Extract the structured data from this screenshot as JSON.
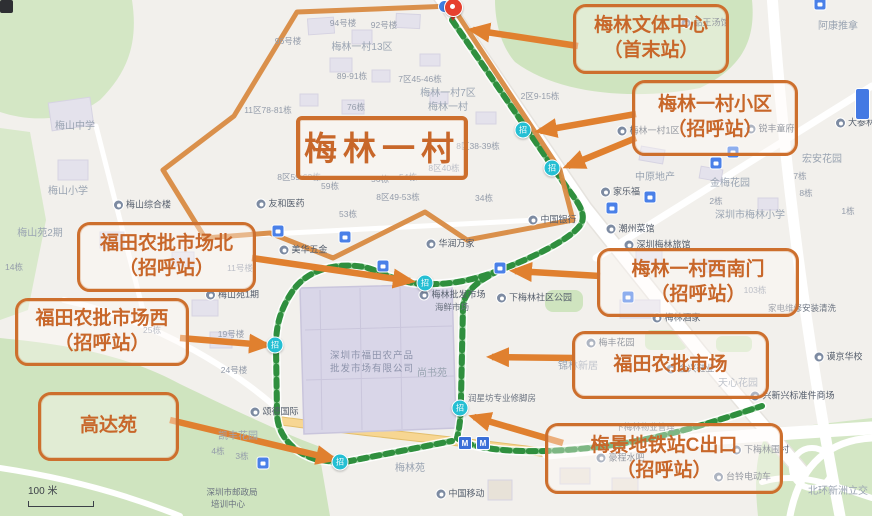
{
  "colors": {
    "accent": "#cd6f2d",
    "arrow": "#e0802f",
    "route_green": "#2f8f3e",
    "route_light": "#9fd3a4",
    "station_cyan": "#25bfd3",
    "park": "#d4e7c5",
    "road_yellow": "#f7d692",
    "pin_red": "#e6402e"
  },
  "map": {
    "scale_text": "100 米",
    "station_glyph": "招",
    "metro_glyph": "M",
    "terminal_pin": [
      452,
      22
    ],
    "stations": [
      [
        523,
        130
      ],
      [
        552,
        168
      ],
      [
        425,
        283
      ],
      [
        275,
        345
      ],
      [
        340,
        462
      ],
      [
        460,
        408
      ]
    ],
    "bus_icons": [
      [
        820,
        4
      ],
      [
        733,
        152
      ],
      [
        716,
        163
      ],
      [
        650,
        197
      ],
      [
        612,
        208
      ],
      [
        278,
        231
      ],
      [
        345,
        237
      ],
      [
        383,
        266
      ],
      [
        500,
        268
      ],
      [
        628,
        297
      ],
      [
        263,
        463
      ]
    ],
    "metro_icons": [
      [
        465,
        443
      ],
      [
        483,
        443
      ]
    ],
    "labels": [
      {
        "text": "梅山中学",
        "x": 75,
        "y": 127,
        "type": "ghost"
      },
      {
        "text": "梅山小学",
        "x": 68,
        "y": 192,
        "type": "ghost"
      },
      {
        "text": "梅山综合楼",
        "x": 142,
        "y": 205,
        "type": "poi"
      },
      {
        "text": "友和医药",
        "x": 280,
        "y": 204,
        "type": "poi"
      },
      {
        "text": "梅山苑2期",
        "x": 40,
        "y": 234,
        "type": "ghost"
      },
      {
        "text": "梅山苑1期",
        "x": 232,
        "y": 295,
        "type": "poi"
      },
      {
        "text": "14栋",
        "x": 14,
        "y": 267,
        "type": "num"
      },
      {
        "text": "11号楼",
        "x": 240,
        "y": 268,
        "type": "num"
      },
      {
        "text": "19号楼",
        "x": 231,
        "y": 334,
        "type": "num"
      },
      {
        "text": "24号楼",
        "x": 234,
        "y": 370,
        "type": "num"
      },
      {
        "text": "25栋",
        "x": 152,
        "y": 330,
        "type": "num"
      },
      {
        "text": "96号楼",
        "x": 288,
        "y": 41,
        "type": "num"
      },
      {
        "text": "94号楼",
        "x": 343,
        "y": 23,
        "type": "num"
      },
      {
        "text": "92号楼",
        "x": 384,
        "y": 25,
        "type": "num"
      },
      {
        "text": "梅林一村13区",
        "x": 362,
        "y": 48,
        "type": "ghost"
      },
      {
        "text": "89-91栋",
        "x": 352,
        "y": 76,
        "type": "num"
      },
      {
        "text": "7区45-46栋",
        "x": 420,
        "y": 79,
        "type": "num"
      },
      {
        "text": "76栋",
        "x": 356,
        "y": 107,
        "type": "num"
      },
      {
        "text": "11区78-81栋",
        "x": 268,
        "y": 110,
        "type": "num"
      },
      {
        "text": "梅林一村7区",
        "x": 448,
        "y": 94,
        "type": "ghost"
      },
      {
        "text": "2区9-15栋",
        "x": 540,
        "y": 96,
        "type": "num"
      },
      {
        "text": "梅林一村",
        "x": 448,
        "y": 108,
        "type": "ghost"
      },
      {
        "text": "梅林一村1区",
        "x": 648,
        "y": 131,
        "type": "poi"
      },
      {
        "text": "锐丰童府",
        "x": 770,
        "y": 129,
        "type": "poi"
      },
      {
        "text": "品王汤馆",
        "x": 705,
        "y": 23,
        "type": "poi"
      },
      {
        "text": "阿康推拿",
        "x": 838,
        "y": 27,
        "type": "ghost"
      },
      {
        "text": "大参林",
        "x": 855,
        "y": 123,
        "type": "poi"
      },
      {
        "text": "8区38-39栋",
        "x": 478,
        "y": 146,
        "type": "num"
      },
      {
        "text": "8区40栋",
        "x": 444,
        "y": 168,
        "type": "num"
      },
      {
        "text": "8区59-62栋",
        "x": 299,
        "y": 177,
        "type": "num"
      },
      {
        "text": "59栋",
        "x": 330,
        "y": 186,
        "type": "num"
      },
      {
        "text": "56栋",
        "x": 380,
        "y": 179,
        "type": "num"
      },
      {
        "text": "54栋",
        "x": 408,
        "y": 177,
        "type": "num"
      },
      {
        "text": "8区49-53栋",
        "x": 398,
        "y": 197,
        "type": "num"
      },
      {
        "text": "53栋",
        "x": 348,
        "y": 214,
        "type": "num"
      },
      {
        "text": "34栋",
        "x": 484,
        "y": 198,
        "type": "num"
      },
      {
        "text": "中国银行",
        "x": 552,
        "y": 220,
        "type": "poi"
      },
      {
        "text": "美华五金",
        "x": 303,
        "y": 250,
        "type": "poi"
      },
      {
        "text": "华润万家",
        "x": 450,
        "y": 244,
        "type": "poi"
      },
      {
        "text": "梅林批发市场",
        "x": 452,
        "y": 295,
        "type": "poi"
      },
      {
        "text": "海鲜市场",
        "x": 452,
        "y": 307,
        "type": "plain"
      },
      {
        "text": "下梅林社区公园",
        "x": 534,
        "y": 298,
        "type": "poi"
      },
      {
        "text": "家乐福",
        "x": 620,
        "y": 192,
        "type": "poi"
      },
      {
        "text": "中原地产",
        "x": 655,
        "y": 178,
        "type": "ghost"
      },
      {
        "text": "金梅花园",
        "x": 730,
        "y": 184,
        "type": "ghost"
      },
      {
        "text": "宏安花园",
        "x": 822,
        "y": 160,
        "type": "ghost"
      },
      {
        "text": "7栋",
        "x": 800,
        "y": 176,
        "type": "num"
      },
      {
        "text": "8栋",
        "x": 806,
        "y": 193,
        "type": "num"
      },
      {
        "text": "2栋",
        "x": 716,
        "y": 201,
        "type": "num"
      },
      {
        "text": "1栋",
        "x": 848,
        "y": 211,
        "type": "num"
      },
      {
        "text": "深圳市梅林小学",
        "x": 750,
        "y": 216,
        "type": "ghost"
      },
      {
        "text": "潮州菜馆",
        "x": 630,
        "y": 229,
        "type": "poi"
      },
      {
        "text": "深圳梅林旅馆",
        "x": 657,
        "y": 245,
        "type": "poi"
      },
      {
        "text": "103栋",
        "x": 755,
        "y": 290,
        "type": "num"
      },
      {
        "text": "家电维修安装清洗",
        "x": 802,
        "y": 308,
        "type": "plain"
      },
      {
        "text": "梅林酒家",
        "x": 676,
        "y": 318,
        "type": "poi"
      },
      {
        "text": "梅丰花园",
        "x": 610,
        "y": 343,
        "type": "poi"
      },
      {
        "text": "锦林新居",
        "x": 578,
        "y": 367,
        "type": "ghost"
      },
      {
        "text": "金兴鞋业",
        "x": 690,
        "y": 369,
        "type": "poi"
      },
      {
        "text": "天心花园",
        "x": 738,
        "y": 384,
        "type": "ghost"
      },
      {
        "text": "兴新兴标准件商场",
        "x": 792,
        "y": 396,
        "type": "poi"
      },
      {
        "text": "谟京华校",
        "x": 838,
        "y": 357,
        "type": "poi"
      },
      {
        "text": "下梅林物业管理",
        "x": 645,
        "y": 427,
        "type": "plain"
      },
      {
        "text": "下梅林围村",
        "x": 760,
        "y": 450,
        "type": "poi"
      },
      {
        "text": "台铃电动车",
        "x": 742,
        "y": 477,
        "type": "poi"
      },
      {
        "text": "豪程水吧",
        "x": 620,
        "y": 458,
        "type": "poi"
      },
      {
        "text": "北环新洲立交",
        "x": 838,
        "y": 492,
        "type": "ghost"
      },
      {
        "text": "颂德国际",
        "x": 274,
        "y": 412,
        "type": "poi"
      },
      {
        "text": "凯丰花园",
        "x": 238,
        "y": 437,
        "type": "ghost"
      },
      {
        "text": "4栋",
        "x": 218,
        "y": 451,
        "type": "num"
      },
      {
        "text": "3栋",
        "x": 242,
        "y": 456,
        "type": "num"
      },
      {
        "text": "深圳市邮政局",
        "x": 232,
        "y": 492,
        "type": "plain"
      },
      {
        "text": "培训中心",
        "x": 228,
        "y": 504,
        "type": "plain"
      },
      {
        "text": "梅林苑",
        "x": 410,
        "y": 469,
        "type": "ghost"
      },
      {
        "text": "中国移动",
        "x": 460,
        "y": 494,
        "type": "poi"
      },
      {
        "text": "润星坊专业修脚房",
        "x": 502,
        "y": 398,
        "type": "plain"
      },
      {
        "text": "尚书苑",
        "x": 432,
        "y": 374,
        "type": "ghost"
      },
      {
        "text": "深圳市福田农产品",
        "x": 372,
        "y": 356,
        "type": "bldg"
      },
      {
        "text": "批发市场有限公司",
        "x": 372,
        "y": 369,
        "type": "bldg"
      }
    ]
  },
  "callouts": [
    {
      "lines": [
        "梅林文体中心",
        "（首末站）"
      ],
      "box": [
        573,
        4,
        150,
        64
      ],
      "big": false,
      "arrows": [
        [
          578,
          46,
          473,
          30
        ]
      ]
    },
    {
      "lines": [
        "梅林一村小区",
        "（招呼站）"
      ],
      "box": [
        632,
        80,
        160,
        70
      ],
      "big": false,
      "arrows": [
        [
          636,
          114,
          540,
          131
        ],
        [
          636,
          138,
          568,
          166
        ]
      ]
    },
    {
      "lines": [
        "梅林一村"
      ],
      "box": [
        296,
        116,
        164,
        56
      ],
      "big": true,
      "arrows": []
    },
    {
      "lines": [
        "福田农批市场北",
        "（招呼站）"
      ],
      "box": [
        77,
        222,
        173,
        64
      ],
      "big": false,
      "arrows": [
        [
          252,
          258,
          410,
          281
        ]
      ]
    },
    {
      "lines": [
        "福田农批市场西",
        "（招呼站）"
      ],
      "box": [
        15,
        298,
        168,
        62
      ],
      "big": false,
      "arrows": [
        [
          180,
          338,
          266,
          345
        ]
      ]
    },
    {
      "lines": [
        "梅林一村西南门",
        "（招呼站）"
      ],
      "box": [
        597,
        248,
        196,
        63
      ],
      "big": false,
      "arrows": [
        [
          600,
          276,
          515,
          271
        ]
      ]
    },
    {
      "lines": [
        "福田农批市场"
      ],
      "box": [
        572,
        331,
        191,
        62
      ],
      "big": false,
      "arrows": [
        [
          574,
          358,
          492,
          357
        ]
      ]
    },
    {
      "lines": [
        "高达苑"
      ],
      "box": [
        38,
        392,
        135,
        63
      ],
      "big": false,
      "arrows": [
        [
          170,
          420,
          333,
          459
        ]
      ]
    },
    {
      "lines": [
        "梅景地铁站C出口",
        "（招呼站）"
      ],
      "box": [
        545,
        423,
        232,
        65
      ],
      "big": false,
      "arrows": [
        [
          563,
          443,
          474,
          417
        ]
      ]
    }
  ]
}
